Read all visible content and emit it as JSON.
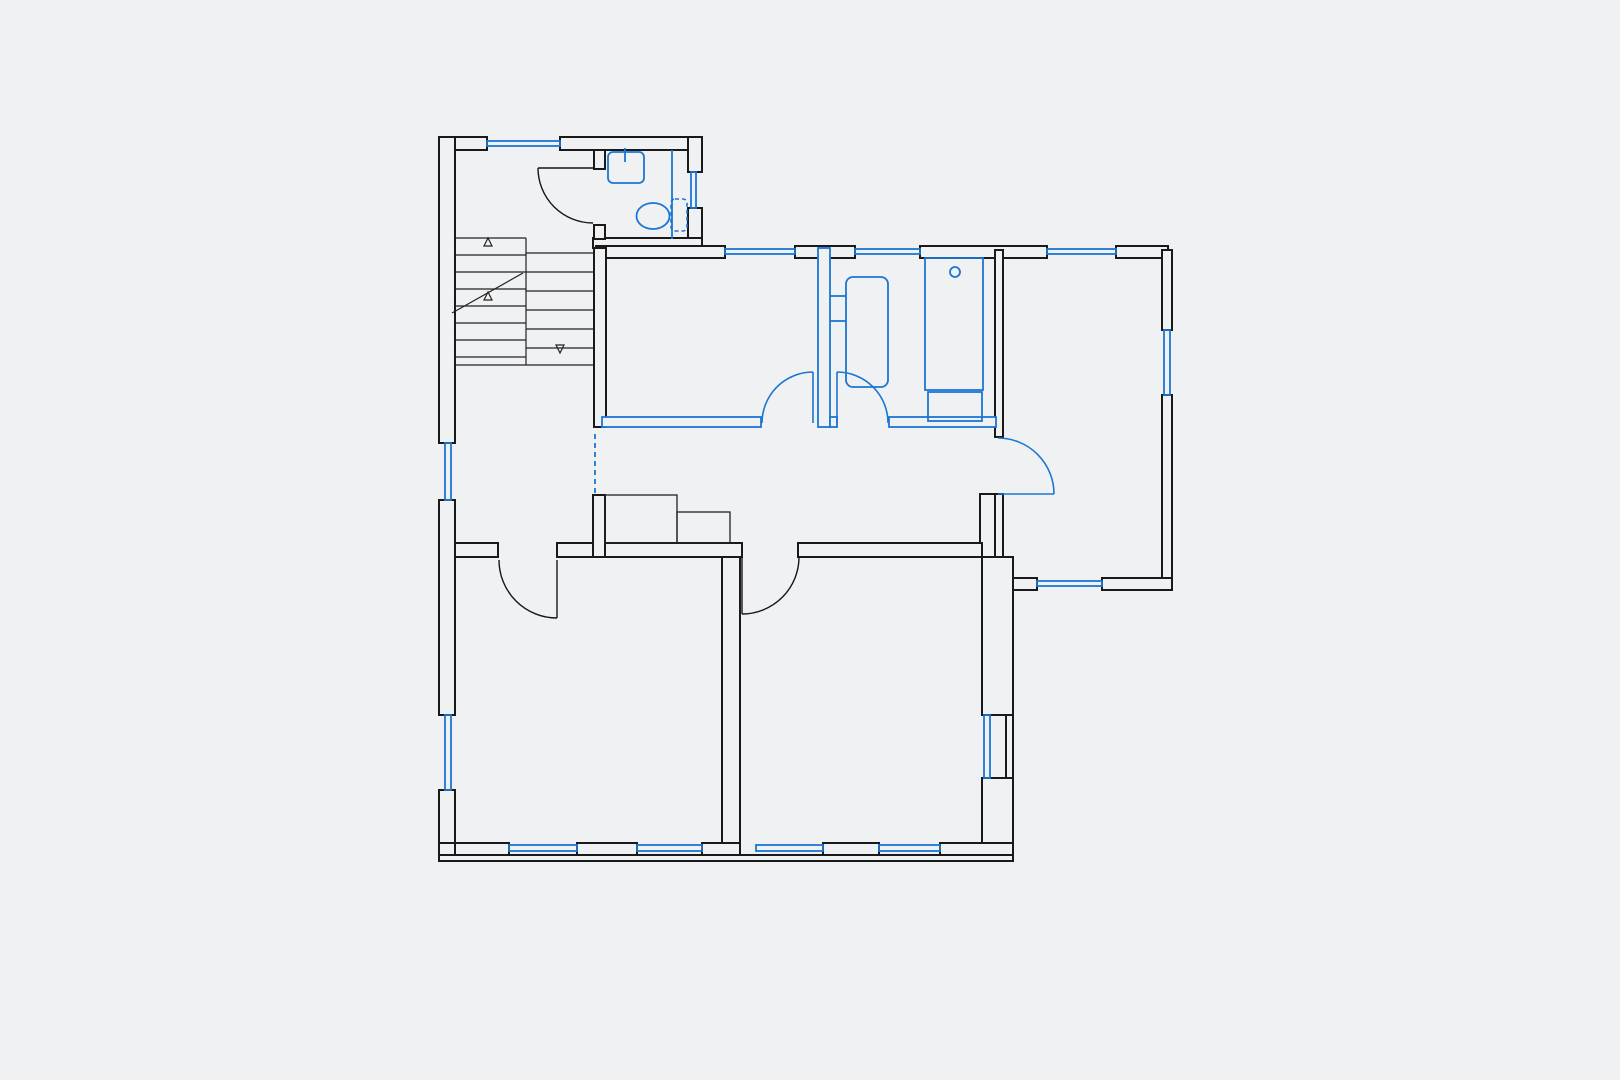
{
  "document": {
    "type": "architectural floor plan",
    "notes": "monochrome plan; existing walls black, new/changed elements (windows, partitions, doors, sanitary fixtures) in blue; no text labels rendered"
  },
  "colors": {
    "background": "#f0f1f2",
    "wall": "#1a1a1a",
    "blue_elements": "#1b76d4"
  },
  "canvas": {
    "width": 1620,
    "height": 1080
  },
  "rooms": [
    {
      "name": "stair-hall",
      "bbox": [
        455,
        150,
        140,
        393
      ]
    },
    {
      "name": "wc",
      "bbox": [
        604,
        150,
        85,
        89
      ]
    },
    {
      "name": "room-top-middle",
      "bbox": [
        608,
        258,
        210,
        159
      ]
    },
    {
      "name": "bathroom",
      "bbox": [
        830,
        258,
        165,
        159
      ]
    },
    {
      "name": "corridor",
      "bbox": [
        596,
        427,
        386,
        116
      ]
    },
    {
      "name": "room-right",
      "bbox": [
        1003,
        258,
        159,
        320
      ]
    },
    {
      "name": "room-bottom-left",
      "bbox": [
        455,
        557,
        267,
        286
      ]
    },
    {
      "name": "room-bottom-right",
      "bbox": [
        740,
        557,
        242,
        286
      ]
    }
  ],
  "walls_black": [
    {
      "name": "top-wall-left",
      "r": [
        439,
        137,
        48,
        13
      ]
    },
    {
      "name": "top-wall-right",
      "r": [
        560,
        137,
        142,
        13
      ]
    },
    {
      "name": "west-wall-1",
      "r": [
        439,
        137,
        16,
        306
      ]
    },
    {
      "name": "west-wall-2",
      "r": [
        439,
        500,
        16,
        215
      ]
    },
    {
      "name": "west-wall-3",
      "r": [
        439,
        790,
        16,
        70
      ]
    },
    {
      "name": "wc-east-wall-1",
      "r": [
        688,
        137,
        14,
        35
      ]
    },
    {
      "name": "wc-east-wall-2",
      "r": [
        688,
        208,
        14,
        40
      ]
    },
    {
      "name": "wc-south-wall",
      "r": [
        593,
        238,
        109,
        10
      ]
    },
    {
      "name": "wc-west-wall-1",
      "r": [
        594,
        150,
        11,
        19
      ]
    },
    {
      "name": "wc-west-wall-2",
      "r": [
        594,
        225,
        11,
        14
      ]
    },
    {
      "name": "north-wall-a",
      "r": [
        596,
        246,
        129,
        12
      ]
    },
    {
      "name": "north-wall-b",
      "r": [
        795,
        246,
        60,
        12
      ]
    },
    {
      "name": "north-wall-c",
      "r": [
        920,
        246,
        127,
        12
      ]
    },
    {
      "name": "north-wall-d",
      "r": [
        1116,
        246,
        52,
        12
      ]
    },
    {
      "name": "east-wall-1",
      "r": [
        1162,
        250,
        10,
        80
      ]
    },
    {
      "name": "east-wall-2",
      "r": [
        1162,
        395,
        10,
        193
      ]
    },
    {
      "name": "room-right-south-a",
      "r": [
        1001,
        578,
        36,
        12
      ]
    },
    {
      "name": "room-right-south-b",
      "r": [
        1102,
        578,
        70,
        12
      ]
    },
    {
      "name": "room-right-west-1",
      "r": [
        995,
        250,
        8,
        187
      ]
    },
    {
      "name": "room-right-west-2",
      "r": [
        995,
        494,
        8,
        63
      ]
    },
    {
      "name": "corridor-east-stub",
      "r": [
        980,
        494,
        15,
        63
      ]
    },
    {
      "name": "se-east-wall-1",
      "r": [
        982,
        557,
        31,
        158
      ]
    },
    {
      "name": "se-east-wall-2",
      "r": [
        982,
        778,
        31,
        82
      ]
    },
    {
      "name": "se-east-wall-outer",
      "r": [
        1006,
        715,
        7,
        63
      ]
    },
    {
      "name": "room-mid-west-wall",
      "r": [
        594,
        248,
        12,
        179
      ]
    },
    {
      "name": "bottom-rooms-north-a",
      "r": [
        455,
        543,
        43,
        14
      ]
    },
    {
      "name": "bottom-rooms-north-b",
      "r": [
        557,
        543,
        185,
        14
      ]
    },
    {
      "name": "bottom-rooms-north-c",
      "r": [
        798,
        543,
        184,
        14
      ]
    },
    {
      "name": "hall-corridor-stub",
      "r": [
        593,
        495,
        12,
        62
      ]
    },
    {
      "name": "bottom-rooms-divider",
      "r": [
        722,
        557,
        18,
        286
      ]
    },
    {
      "name": "south-wall-outer-band",
      "r": [
        439,
        855,
        574,
        6
      ]
    },
    {
      "name": "south-pier-corner",
      "r": [
        439,
        843,
        16,
        12
      ]
    },
    {
      "name": "south-pier-1",
      "r": [
        455,
        843,
        54,
        12
      ]
    },
    {
      "name": "south-pier-2",
      "r": [
        577,
        843,
        60,
        12
      ]
    },
    {
      "name": "south-pier-3",
      "r": [
        702,
        843,
        38,
        12
      ]
    },
    {
      "name": "south-pier-4",
      "r": [
        823,
        843,
        56,
        12
      ]
    },
    {
      "name": "south-pier-5",
      "r": [
        940,
        843,
        73,
        12
      ]
    }
  ],
  "walls_blue": [
    {
      "name": "partition-mid-bath",
      "r": [
        818,
        248,
        12,
        179
      ]
    },
    {
      "name": "room-mid-south-wall",
      "r": [
        602,
        417,
        159,
        10
      ]
    },
    {
      "name": "bath-south-stub",
      "r": [
        830,
        417,
        7,
        10
      ]
    },
    {
      "name": "bath-south-wall",
      "r": [
        889,
        417,
        107,
        10
      ]
    }
  ],
  "windows": [
    {
      "name": "window-top-hall",
      "r": [
        487,
        141,
        73,
        5
      ]
    },
    {
      "name": "window-west-hall",
      "r": [
        445,
        443,
        6,
        57
      ]
    },
    {
      "name": "window-west-bottom-room",
      "r": [
        445,
        715,
        6,
        75
      ]
    },
    {
      "name": "window-wc-east",
      "r": [
        691,
        172,
        5,
        36
      ]
    },
    {
      "name": "window-room-mid-north",
      "r": [
        725,
        249,
        70,
        5
      ]
    },
    {
      "name": "window-bath-north",
      "r": [
        855,
        249,
        65,
        5
      ]
    },
    {
      "name": "window-room-right-north",
      "r": [
        1047,
        249,
        69,
        5
      ]
    },
    {
      "name": "window-room-right-east",
      "r": [
        1164,
        330,
        6,
        65
      ]
    },
    {
      "name": "window-room-right-south",
      "r": [
        1037,
        581,
        65,
        5
      ]
    },
    {
      "name": "window-se-east",
      "r": [
        984,
        715,
        6,
        63
      ]
    },
    {
      "name": "window-south-1",
      "r": [
        509,
        845,
        68,
        6
      ]
    },
    {
      "name": "window-south-2",
      "r": [
        637,
        845,
        65,
        6
      ]
    },
    {
      "name": "window-south-3",
      "r": [
        756,
        845,
        67,
        6
      ]
    },
    {
      "name": "window-south-4",
      "r": [
        879,
        845,
        61,
        6
      ]
    }
  ],
  "doors": [
    {
      "name": "door-wc",
      "color": "black",
      "panel": [
        538,
        168,
        593,
        168
      ],
      "arc": "M538,168 A55,55 0 0 0 593,223"
    },
    {
      "name": "door-room-bottom-left",
      "color": "black",
      "panel": [
        557,
        560,
        557,
        618
      ],
      "arc": "M499,560 A58,58 0 0 0 557,618"
    },
    {
      "name": "door-room-bottom-right",
      "color": "black",
      "panel": [
        742,
        557,
        742,
        614
      ],
      "arc": "M742,614 A57,57 0 0 0 799,557"
    },
    {
      "name": "door-room-mid",
      "color": "blue",
      "panel": [
        813,
        423,
        813,
        372
      ],
      "arc": "M762,423 A51,51 0 0 1 813,372"
    },
    {
      "name": "door-bathroom",
      "color": "blue",
      "panel": [
        837,
        423,
        837,
        372
      ],
      "arc": "M837,372 A51,51 0 0 1 888,423"
    },
    {
      "name": "door-room-right",
      "color": "blue",
      "panel": [
        998,
        494,
        1054,
        494
      ],
      "arc": "M998,438 A56,56 0 0 1 1054,494"
    }
  ],
  "dashed_openings": [
    {
      "name": "removed-wall-hall-corridor",
      "line": [
        595,
        434,
        595,
        494
      ]
    }
  ],
  "stairs": {
    "lines": [
      [
        455,
        238,
        526,
        238
      ],
      [
        455,
        365,
        593,
        365
      ],
      [
        526,
        238,
        526,
        365
      ],
      [
        526,
        253,
        593,
        253
      ],
      [
        455,
        255,
        526,
        255
      ],
      [
        455,
        272,
        526,
        272
      ],
      [
        455,
        289,
        526,
        289
      ],
      [
        455,
        306,
        526,
        306
      ],
      [
        455,
        323,
        526,
        323
      ],
      [
        455,
        340,
        526,
        340
      ],
      [
        455,
        357,
        526,
        357
      ],
      [
        526,
        272,
        593,
        272
      ],
      [
        526,
        291,
        593,
        291
      ],
      [
        526,
        310,
        593,
        310
      ],
      [
        526,
        329,
        593,
        329
      ],
      [
        526,
        348,
        593,
        348
      ],
      [
        452,
        313,
        523,
        273
      ]
    ],
    "triangles": [
      {
        "name": "stair-arrow-up-1",
        "points": "488,238 484,246 492,246"
      },
      {
        "name": "stair-arrow-up-2",
        "points": "488,292 484,300 492,300"
      },
      {
        "name": "stair-arrow-down",
        "points": "560,353 556,345 564,345"
      }
    ]
  },
  "cabinets": [
    {
      "name": "corridor-cabinet-tall",
      "r": [
        605,
        495,
        72,
        48
      ]
    },
    {
      "name": "corridor-cabinet-low",
      "r": [
        677,
        512,
        53,
        31
      ]
    }
  ],
  "fixtures": {
    "sink": {
      "rect": [
        608,
        152,
        36,
        31
      ],
      "tap": [
        625,
        148,
        625,
        162
      ]
    },
    "toilet": {
      "bowl": [
        653,
        216,
        16.5,
        13
      ],
      "cistern": [
        671,
        199,
        16,
        32
      ]
    },
    "wc_partition_line": [
      672,
      150,
      672,
      239
    ],
    "radiator": {
      "rect": [
        846,
        277,
        42,
        110
      ],
      "ticks": [
        [
          830,
          296,
          846,
          296
        ],
        [
          830,
          321,
          846,
          321
        ]
      ]
    },
    "shower_tub": {
      "rect": [
        925,
        258,
        58,
        132
      ],
      "drain": [
        955,
        272,
        5
      ]
    },
    "appliance": {
      "rect": [
        928,
        392,
        54,
        29
      ]
    }
  }
}
